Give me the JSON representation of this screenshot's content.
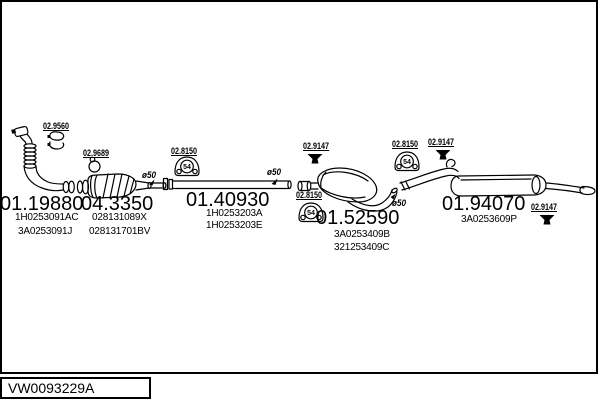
{
  "ref": "VW0093229A",
  "hanger_stamp": "54",
  "colors": {
    "line": "#000000",
    "background": "#ffffff"
  },
  "parts": [
    {
      "name": "front-pipe",
      "code": "01.19880",
      "oem_a": "1H0253091AC",
      "oem_b": "3A0253091J"
    },
    {
      "name": "catalytic-converter",
      "code": "04.3350",
      "oem_a": "028131089X",
      "oem_b": "028131701BV"
    },
    {
      "name": "center-pipe",
      "code": "01.40930",
      "oem_a": "1H0253203A",
      "oem_b": "1H0253203E"
    },
    {
      "name": "center-muffler",
      "code": "01.52590",
      "oem_a": "3A0253409B",
      "oem_b": "321253409C"
    },
    {
      "name": "rear-muffler",
      "code": "01.94070",
      "oem_a": "3A0253609P"
    }
  ],
  "fittings": [
    {
      "code": "02.9560",
      "type": "clamp"
    },
    {
      "code": "02.9689",
      "type": "gasket-ring"
    },
    {
      "code": "02.8150",
      "type": "rubber-hanger"
    },
    {
      "code": "02.9147",
      "type": "clamp"
    },
    {
      "code": "02.8150",
      "type": "rubber-hanger"
    },
    {
      "code": "02.8150",
      "type": "rubber-hanger"
    },
    {
      "code": "02.9147",
      "type": "clamp"
    },
    {
      "code": "02.9147",
      "type": "clamp"
    }
  ],
  "diameters": [
    "ø50",
    "ø50",
    "ø50"
  ]
}
